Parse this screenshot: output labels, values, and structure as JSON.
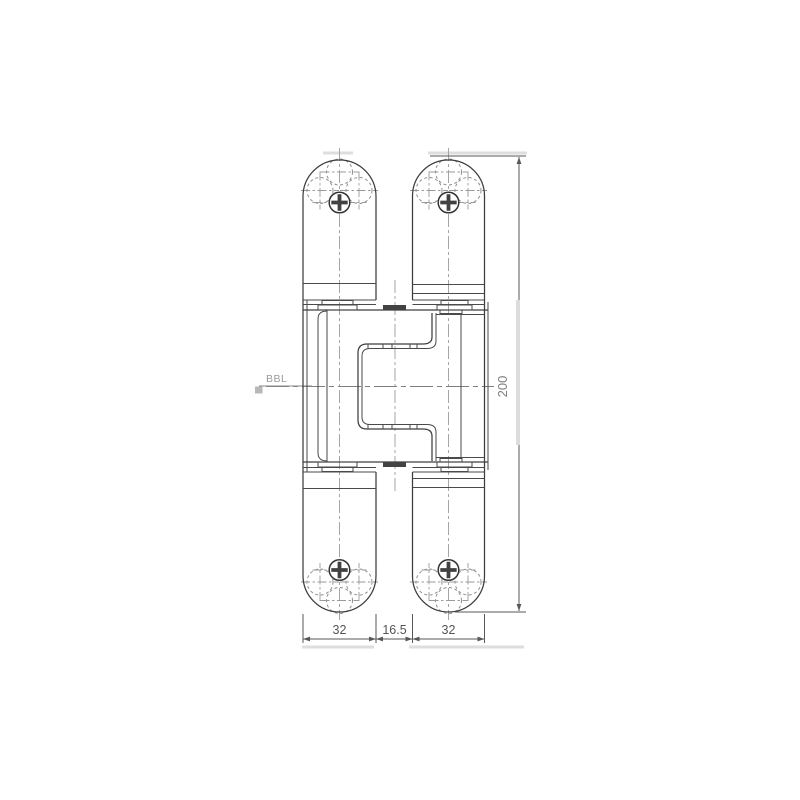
{
  "drawing": {
    "title": "concealed-hinge-front-elevation",
    "labels": {
      "datum": "BBL"
    },
    "dimensions": {
      "bottom": [
        "32",
        "16.5",
        "32"
      ],
      "height": "200"
    },
    "colors": {
      "ink": "#3d3d3d",
      "dimension": "#575757",
      "centerline": "#a5a5a5",
      "hidden_detail": "#8f8f8f",
      "highlight_artifact": "#dedede",
      "background": "#ffffff"
    }
  }
}
